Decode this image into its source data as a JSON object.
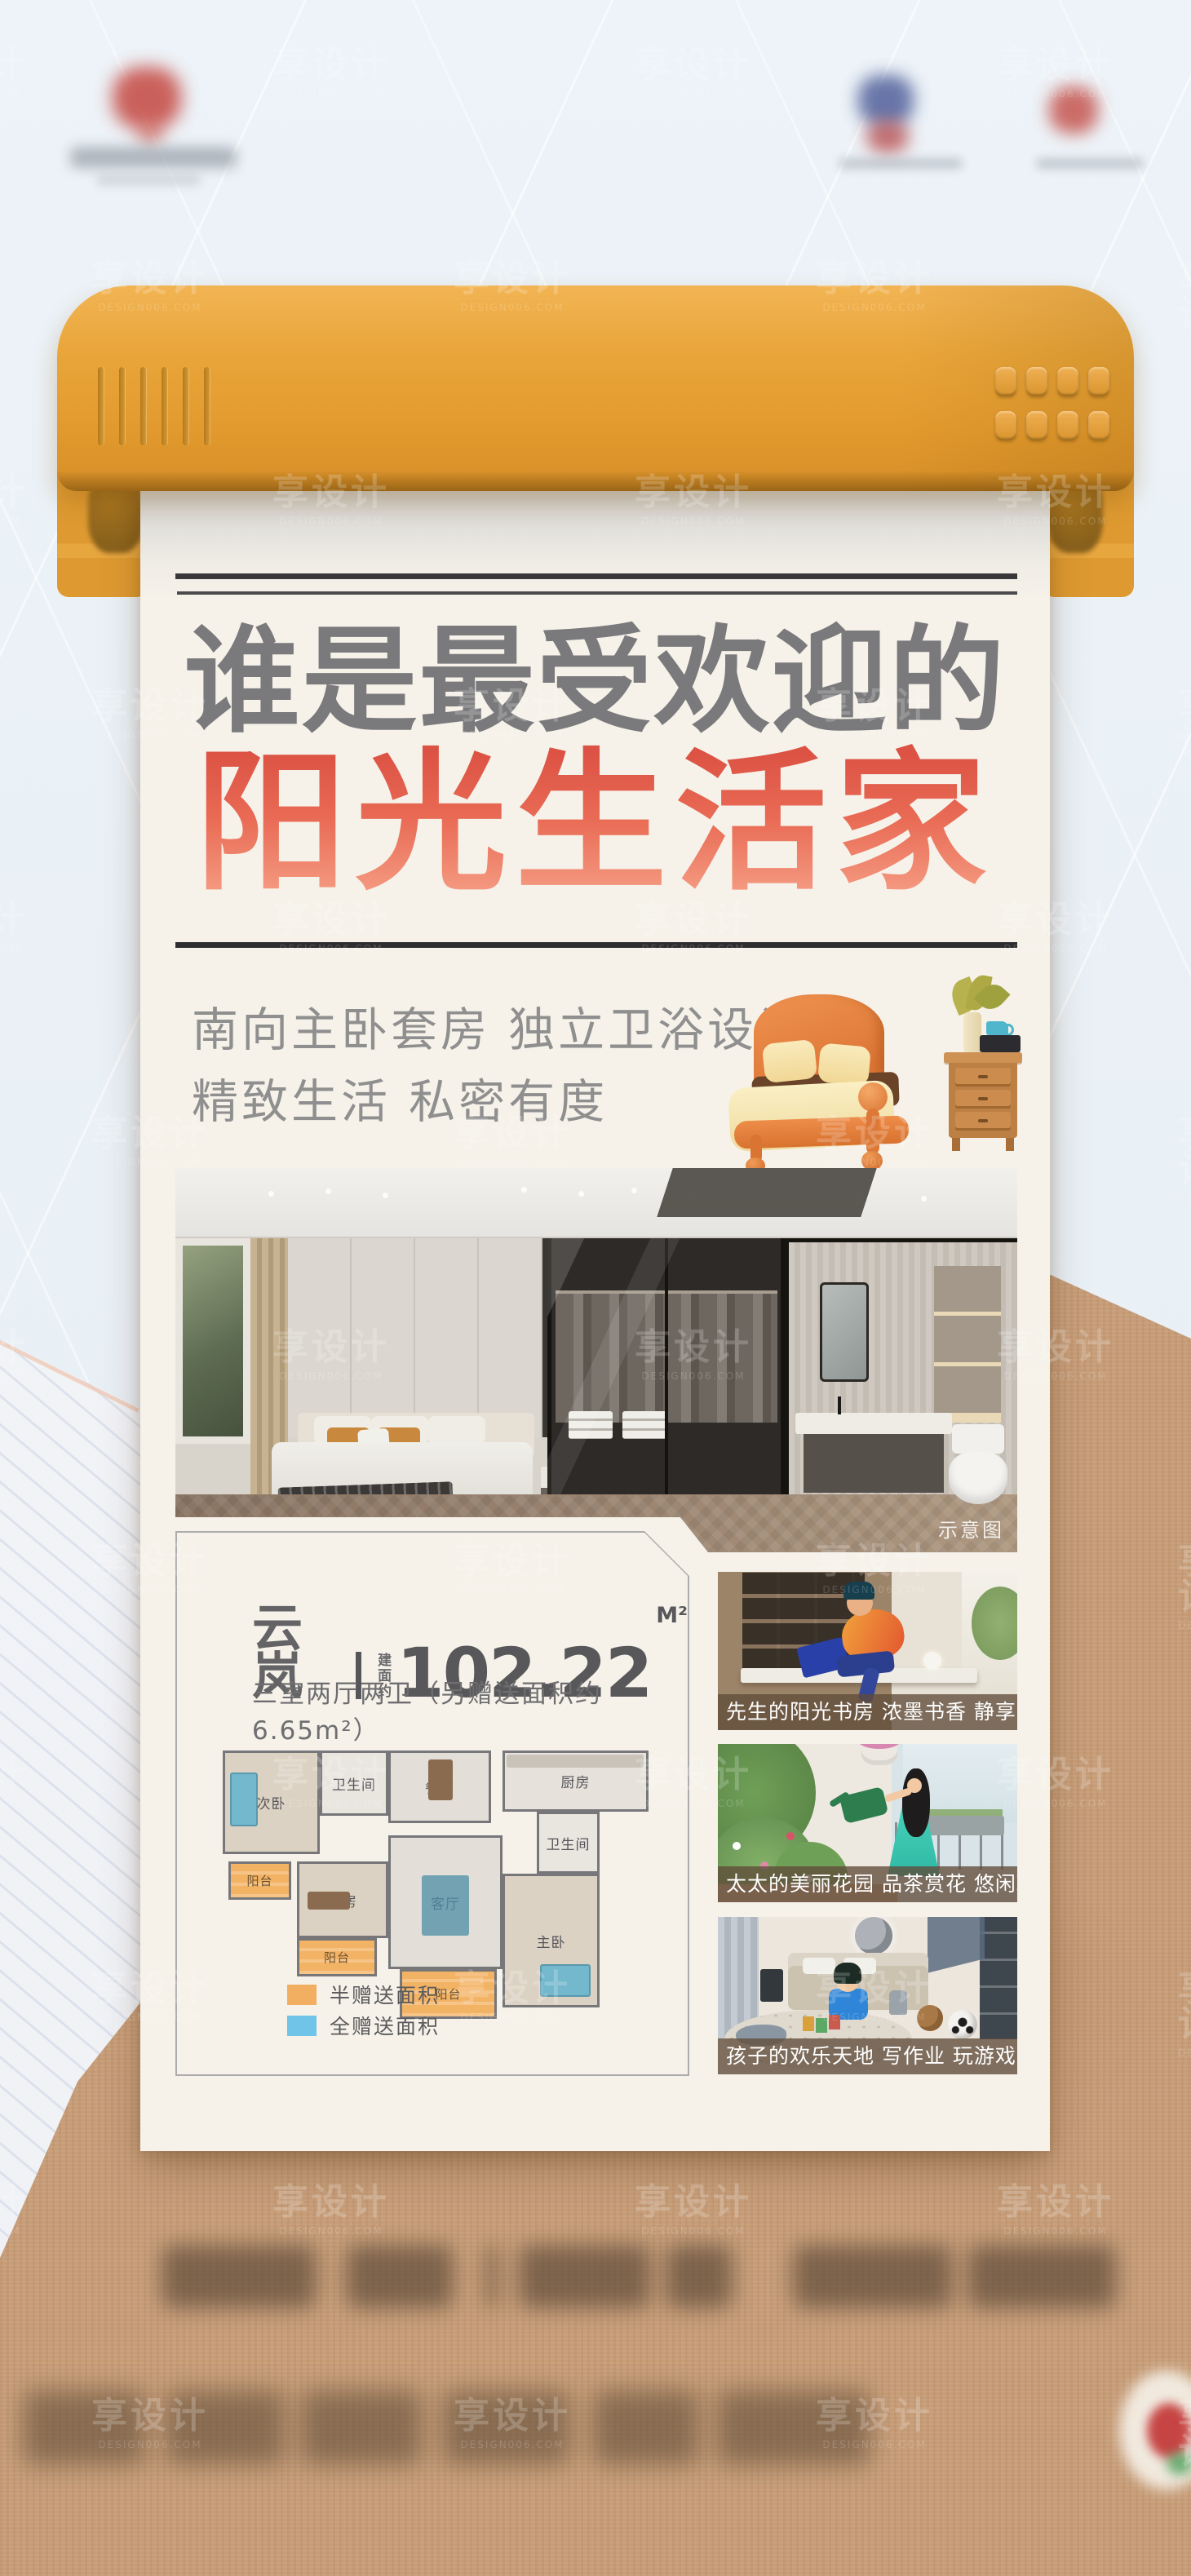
{
  "watermark": {
    "text": "享设计",
    "sub": "DESIGN006.COM"
  },
  "poster": {
    "title_line1": "谁是最受欢迎的",
    "title_line2": "阳光生活家",
    "subtitle_line1": "南向主卧套房 独立卫浴设计",
    "subtitle_line2": "精致生活 私密有度",
    "photo_tag": "示意图",
    "unit": {
      "name": "云岚",
      "area_label": "建面约",
      "area_value": "102.22",
      "area_unit": "M²",
      "layout_desc": "三室两厅两卫（另赠送面积约6.65m²）",
      "legend": [
        {
          "label": "半赠送面积",
          "color": "#F2AF62"
        },
        {
          "label": "全赠送面积",
          "color": "#6FC4E8"
        }
      ],
      "rooms": [
        {
          "name": "次卧"
        },
        {
          "name": "卫生间"
        },
        {
          "name": "餐厅"
        },
        {
          "name": "厨房"
        },
        {
          "name": "卫生间"
        },
        {
          "name": "书房"
        },
        {
          "name": "客厅"
        },
        {
          "name": "主卧"
        },
        {
          "name": "阳台"
        },
        {
          "name": "阳台"
        },
        {
          "name": "阳台"
        }
      ]
    },
    "scenes": [
      {
        "caption": "先生的阳光书房 浓墨书香 静享意趣"
      },
      {
        "caption": "太太的美丽花园 品茶赏花 悠闲瑜伽"
      },
      {
        "caption": "孩子的欢乐天地 写作业 玩游戏 看漫画"
      }
    ],
    "colors": {
      "printer_orange": "#E7A238",
      "title_red": "#DE5749",
      "paper": "#F6F2EA",
      "kraft": "#C79D78"
    }
  }
}
